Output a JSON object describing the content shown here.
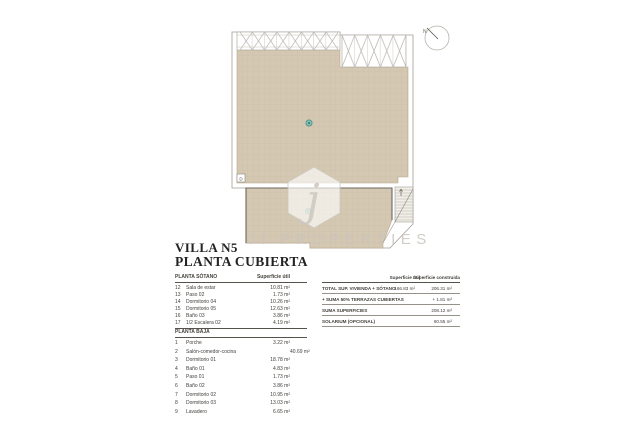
{
  "title": {
    "line1": "VILLA N5",
    "line2": "PLANTA CUBIERTA"
  },
  "watermark": {
    "logo_letter": "j",
    "text": "JI PROPERTIES"
  },
  "plan": {
    "compass_label": "N",
    "detail_marker": "D",
    "colors": {
      "terrace": "#d5c8b2",
      "grid_line": "#c4b59c",
      "outline": "#a29d94",
      "dark_edge": "#6b675f",
      "drain": "#4a9c8e"
    }
  },
  "left_table": {
    "sotano": {
      "header": "PLANTA SÓTANO",
      "header_right": "Superficie útil",
      "rows": [
        {
          "n": "12",
          "name": "Sala de estar",
          "util": "10.81 m²",
          "extra": ""
        },
        {
          "n": "13",
          "name": "Paso 02",
          "util": "1.73 m²",
          "extra": ""
        },
        {
          "n": "14",
          "name": "Dormitorio 04",
          "util": "10.26 m²",
          "extra": ""
        },
        {
          "n": "15",
          "name": "Dormitorio 05",
          "util": "12.63 m²",
          "extra": ""
        },
        {
          "n": "16",
          "name": "Baño 03",
          "util": "3.86 m²",
          "extra": ""
        },
        {
          "n": "17",
          "name": "1/2 Escalera 02",
          "util": "4.19 m²",
          "extra": ""
        }
      ]
    },
    "baja": {
      "header": "PLANTA BAJA",
      "rows": [
        {
          "n": "1",
          "name": "Porche",
          "util": "3.22 m²",
          "extra": ""
        },
        {
          "n": "2",
          "name": "Salón-comedor-cocina",
          "util": "",
          "extra": "40.69 m²"
        },
        {
          "n": "3",
          "name": "Dormitorio 01",
          "util": "18.78 m²",
          "extra": ""
        },
        {
          "n": "4",
          "name": "Baño 01",
          "util": "4.83 m²",
          "extra": ""
        },
        {
          "n": "5",
          "name": "Paso 01",
          "util": "1.73 m²",
          "extra": ""
        },
        {
          "n": "6",
          "name": "Baño 02",
          "util": "3.86 m²",
          "extra": ""
        },
        {
          "n": "7",
          "name": "Dormitorio 02",
          "util": "10.95 m²",
          "extra": ""
        },
        {
          "n": "8",
          "name": "Dormitorio 03",
          "util": "13.03 m²",
          "extra": ""
        },
        {
          "n": "9",
          "name": "Lavadero",
          "util": "6.65 m²",
          "extra": ""
        }
      ]
    }
  },
  "summary_table": {
    "header_util": "Superficie útil",
    "header_construida": "Superficie construida",
    "rows": [
      {
        "label": "TOTAL SUP. VIVIENDA + SÓTANO",
        "util": "166.83  m²",
        "construida": "206.31 m²"
      },
      {
        "label": "+ SUMA 50% TERRAZAS CUBIERTAS",
        "util": "",
        "construida": "+ 1.81 m²"
      },
      {
        "label": "SUMA SUPERFICIES",
        "util": "",
        "construida": "208.12 m²"
      },
      {
        "label": "SOLARIUM (OPCIONAL)",
        "util": "",
        "construida": "60.55 m²"
      }
    ]
  }
}
